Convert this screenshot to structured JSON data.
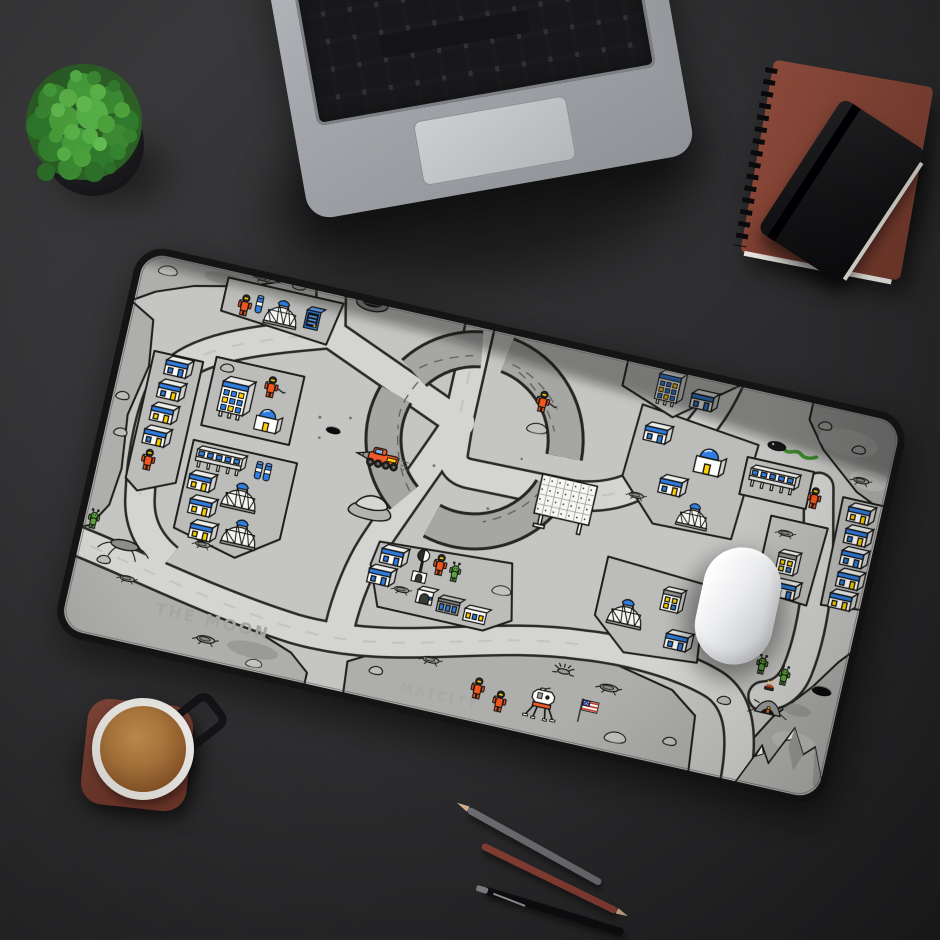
{
  "scene": {
    "setting": "top-down flat-lay of a dark desk",
    "lighting": "soft light from upper left"
  },
  "mat": {
    "product": "moon city illustrated desk mat",
    "moon_label": "THE MOON",
    "city_label": "MATCITY",
    "palette": {
      "base": "#c5c5c3",
      "road": "#d4d4d2",
      "block": "#bcbcba",
      "terrain": "#aeaeac",
      "outline": "#1f1f1d",
      "edge_trim": "#151515",
      "window_blue": "#2f7de0",
      "window_yellow": "#ffcf00",
      "astronaut_orange": "#f0561d",
      "alien_green": "#5aa63e",
      "rover_orange": "#f05a28",
      "flag_red": "#c0392b",
      "flag_blue": "#2c3e8f"
    },
    "features": [
      "central crater ring crossed by roads",
      "geodesic domes",
      "moon base buildings with blue and yellow windows",
      "astronauts in orange space suits",
      "green aliens",
      "mining rover with drill",
      "lunar lander with american flag",
      "solar panel array",
      "rocks, craters and mountains",
      "black-headed snake alien"
    ]
  },
  "desk_items": {
    "plant": "round green potted plant in black pot",
    "laptop": "silver laptop keyboard and trackpad",
    "spiral_notebook": "rust-brown spiral notebook",
    "black_notebook": "black notebook on top",
    "coffee": "espresso cup on square terracotta coaster",
    "mouse": "white wireless mouse",
    "pencils": "gray pencil, red pencil, black pen"
  }
}
